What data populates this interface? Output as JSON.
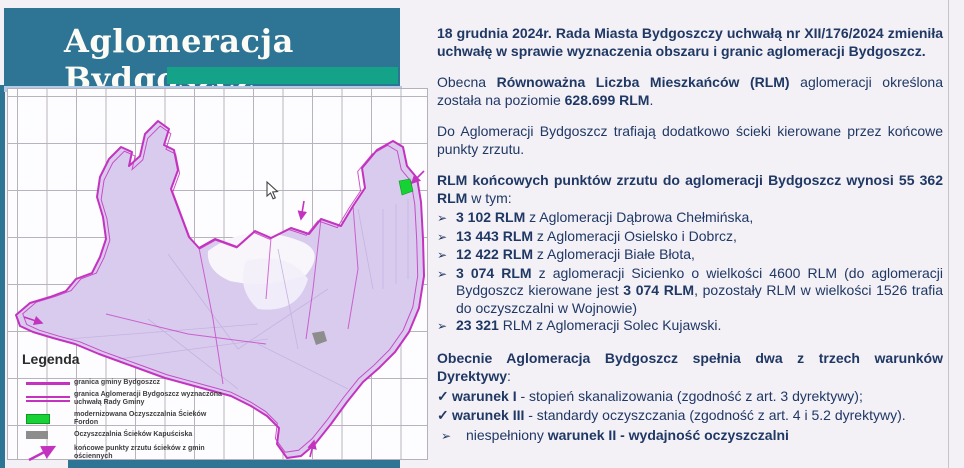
{
  "header": {
    "title": "Aglomeracja Bydgoszcz"
  },
  "map": {
    "legend": {
      "title": "Legenda",
      "items": [
        {
          "swatch": "thick-magenta-line",
          "label": "granica gminy Bydgoszcz"
        },
        {
          "swatch": "double-magenta-line",
          "label": "granica Aglomeracji Bydgoszcz wyznaczona uchwałą Rady Gminy"
        },
        {
          "swatch": "green-rect",
          "label": "modernizowana Oczyszczalnia Ścieków Fordon"
        },
        {
          "swatch": "gray-rect",
          "label": "Oczyszczalnia Ścieków Kapuściska"
        },
        {
          "swatch": "magenta-arrow",
          "label": "końcowe punkty zrzutu ścieków z gmin ościennych"
        }
      ]
    },
    "colors": {
      "boundary_magenta": "#c433c0",
      "urban_lavender": "#d9cbee",
      "marker_green": "#17d234",
      "marker_gray": "#8d8d8d"
    }
  },
  "theme": {
    "header_teal": "#2e7495",
    "accent_green": "#14a288",
    "accent_lightblue": "#b3cbe4",
    "text_navy": "#1f3864"
  },
  "content": {
    "bullet_marker": "➢",
    "check_marker": "✓",
    "para1_runs": [
      {
        "t": "18 grudnia 2024r. Rada Miasta Bydgoszczy uchwałą nr XII/176/2024 zmieniła uchwałę w sprawie wyznaczenia obszaru i granic aglomeracji Bydgoszcz.",
        "b": 1
      }
    ],
    "para2_runs": [
      {
        "t": "Obecna ",
        "b": 0
      },
      {
        "t": "Równoważna Liczba Mieszkańców (RLM)",
        "b": 1
      },
      {
        "t": " aglomeracji określona została na poziomie ",
        "b": 0
      },
      {
        "t": "628.699 RLM",
        "b": 1
      },
      {
        "t": ".",
        "b": 0
      }
    ],
    "para3_runs": [
      {
        "t": "Do Aglomeracji Bydgoszcz trafiają dodatkowo ścieki kierowane przez końcowe punkty zrzutu.",
        "b": 0
      }
    ],
    "para4_runs": [
      {
        "t": "RLM końcowych punktów zrzutu do aglomeracji Bydgoszcz wynosi 55 362 RLM",
        "b": 1
      },
      {
        "t": " w tym:",
        "b": 0
      }
    ],
    "bullets": [
      {
        "runs": [
          {
            "t": "3 102 RLM",
            "b": 1
          },
          {
            "t": " z Aglomeracji Dąbrowa Chełmińska,",
            "b": 0
          }
        ]
      },
      {
        "runs": [
          {
            "t": "13 443 RLM",
            "b": 1
          },
          {
            "t": " z Aglomeracji Osielsko i Dobrcz,",
            "b": 0
          }
        ]
      },
      {
        "runs": [
          {
            "t": "12 422 RLM",
            "b": 1
          },
          {
            "t": " z Aglomeracji Białe Błota,",
            "b": 0
          }
        ]
      },
      {
        "runs": [
          {
            "t": "3 074 RLM",
            "b": 1
          },
          {
            "t": " z aglomeracji Sicienko o wielkości 4600 RLM (do aglomeracji Bydgoszcz kierowane jest ",
            "b": 0
          },
          {
            "t": "3 074 RLM",
            "b": 1
          },
          {
            "t": ", pozostały RLM w wielkości 1526 trafia do oczyszczalni w Wojnowie)",
            "b": 0
          }
        ]
      },
      {
        "runs": [
          {
            "t": "23 321",
            "b": 1
          },
          {
            "t": " RLM z Aglomeracji Solec Kujawski.",
            "b": 0
          }
        ]
      }
    ],
    "para5_runs": [
      {
        "t": "Obecnie Aglomeracja Bydgoszcz spełnia dwa z trzech warunków Dyrektywy",
        "b": 1
      },
      {
        "t": ":",
        "b": 0
      }
    ],
    "checks": [
      {
        "runs": [
          {
            "t": "warunek I",
            "b": 1
          },
          {
            "t": " - stopień skanalizowania (zgodność z art. 3 dyrektywy);",
            "b": 0
          }
        ]
      },
      {
        "runs": [
          {
            "t": "warunek III",
            "b": 1
          },
          {
            "t": "  - standardy oczyszczania (zgodność z art. 4 i 5.2 dyrektywy).",
            "b": 0
          }
        ]
      }
    ],
    "final_runs": [
      {
        "t": "niespełniony ",
        "b": 0
      },
      {
        "t": "warunek II - wydajność oczyszczalni",
        "b": 1
      }
    ]
  }
}
